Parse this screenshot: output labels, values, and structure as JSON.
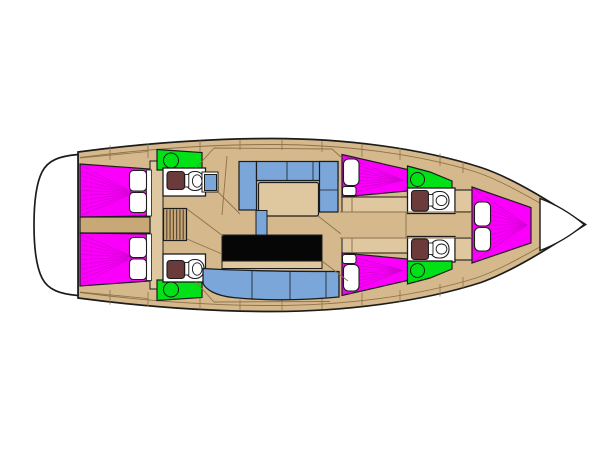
{
  "meta": {
    "description": "Top-view interior layout plan of a sailing yacht; bow pointing right, stern bathing platform at left. No text labels are rendered in the drawing.",
    "canvas": {
      "width": 600,
      "height": 450
    }
  },
  "palette": {
    "background": "#ffffff",
    "wood": "#D5B98D",
    "wood_light": "#DFC8A0",
    "wood_dark": "#C9A877",
    "outline": "#1c1c1c",
    "seam": "#8d7149",
    "berth_magenta": "#FA00FA",
    "berth_line": "#CF00CF",
    "wet_green": "#00E216",
    "upholstery_blue": "#7BA6D9",
    "toilet_brown": "#6B3B3B",
    "counter_black": "#060606",
    "fixture_white": "#FFFFFF",
    "step_line": "#54402e"
  },
  "areas": [
    {
      "name": "stern-bathing-platform",
      "color_key": "fixture_white"
    },
    {
      "name": "aft-cabin-port-berth",
      "color_key": "berth_magenta"
    },
    {
      "name": "aft-cabin-starboard-berth",
      "color_key": "berth_magenta"
    },
    {
      "name": "aft-head-port",
      "color_key": "wet_green"
    },
    {
      "name": "aft-head-starboard",
      "color_key": "wet_green"
    },
    {
      "name": "companionway-steps",
      "color_key": "wood_dark"
    },
    {
      "name": "nav-seat",
      "color_key": "upholstery_blue"
    },
    {
      "name": "saloon-dinette-port",
      "color_key": "upholstery_blue"
    },
    {
      "name": "saloon-table",
      "color_key": "wood_light"
    },
    {
      "name": "centre-counter",
      "color_key": "counter_black"
    },
    {
      "name": "galley-bench-starboard",
      "color_key": "upholstery_blue"
    },
    {
      "name": "mid-cabin-port-berth",
      "color_key": "berth_magenta"
    },
    {
      "name": "mid-cabin-starboard-berth",
      "color_key": "berth_magenta"
    },
    {
      "name": "mid-head-port",
      "color_key": "wet_green"
    },
    {
      "name": "mid-head-starboard",
      "color_key": "wet_green"
    },
    {
      "name": "forward-cabin-v-berth",
      "color_key": "berth_magenta"
    },
    {
      "name": "bow-point",
      "color_key": "fixture_white"
    }
  ],
  "fans": {
    "aft_cabin_top": {
      "origin": [
        134,
        193
      ],
      "edge": [
        [
          82,
          166
        ],
        [
          82,
          215
        ]
      ],
      "lines": 10,
      "color": "berth_line"
    },
    "aft_cabin_bottom": {
      "origin": [
        134,
        257
      ],
      "edge": [
        [
          82,
          235
        ],
        [
          82,
          284
        ]
      ],
      "lines": 10,
      "color": "berth_line"
    },
    "mid_cabin_top": {
      "origin": [
        403,
        180
      ],
      "edge": [
        [
          344,
          156
        ],
        [
          344,
          195
        ]
      ],
      "lines": 8,
      "color": "berth_line"
    },
    "mid_cabin_bottom": {
      "origin": [
        403,
        270
      ],
      "edge": [
        [
          344,
          255
        ],
        [
          344,
          294
        ]
      ],
      "lines": 8,
      "color": "berth_line"
    },
    "bow_cabin": {
      "origin": [
        527,
        225
      ],
      "edge": [
        [
          474,
          189
        ],
        [
          474,
          261
        ]
      ],
      "lines": 10,
      "color": "berth_line"
    }
  },
  "companionway": {
    "x": 163.5,
    "y": 208.5,
    "w": 23,
    "h": 32,
    "steps": 7
  }
}
